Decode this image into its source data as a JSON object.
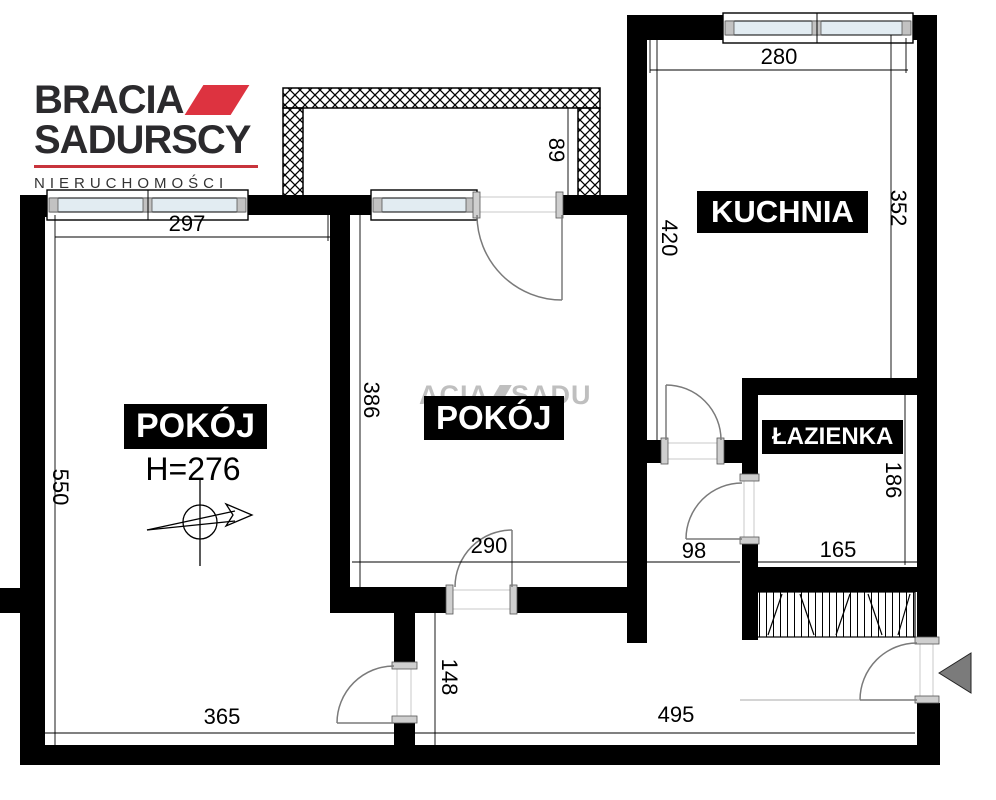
{
  "logo": {
    "line1": "BRACIA",
    "line2": "SADURSCY",
    "subtitle": "NIERUCHOMOŚCI",
    "accent_color": "#dd3340"
  },
  "watermark": {
    "left": "ACIA",
    "right": "SADU"
  },
  "rooms": {
    "room_left": {
      "label": "POKÓJ",
      "ceiling_height": "H=276"
    },
    "room_mid": {
      "label": "POKÓJ"
    },
    "kitchen": {
      "label": "KUCHNIA"
    },
    "bathroom": {
      "label": "ŁAZIENKA"
    }
  },
  "dimensions": {
    "left_room_width_top": "297",
    "left_room_height": "550",
    "left_room_width_bottom": "365",
    "mid_room_height": "386",
    "mid_room_width": "290",
    "balcony_depth": "89",
    "kitchen_width": "280",
    "kitchen_height_left": "420",
    "kitchen_height_right": "352",
    "bathroom_width": "165",
    "bathroom_height": "186",
    "hall_length": "495",
    "hall_width": "148",
    "hall_passage_width": "98"
  }
}
